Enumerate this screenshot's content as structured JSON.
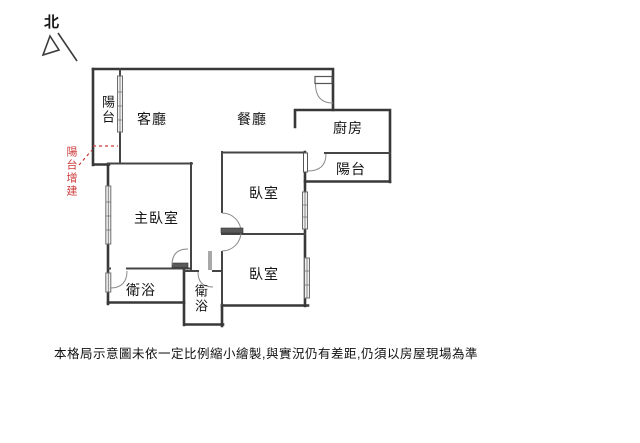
{
  "north": {
    "label": "北"
  },
  "rooms": {
    "living": "客廳",
    "dining": "餐廳",
    "kitchen": "廚房",
    "balcony_left": "陽台",
    "balcony_right": "陽台",
    "master_bedroom": "主臥室",
    "bedroom_1": "臥室",
    "bedroom_2": "臥室",
    "bathroom_1": "衛浴",
    "bathroom_2": "衛浴"
  },
  "annotation": {
    "balcony_extension": "陽台增建",
    "color": "#cc3b3b"
  },
  "disclaimer": "本格局示意圖未依一定比例縮小繪製,與實況仍有差距,仍須以房屋現場為準",
  "colors": {
    "wall": "#383838",
    "inner_wall": "#454545",
    "door_arc": "#8a8a8a",
    "window_fill": "#f0f0f0",
    "annotation_red": "#cc3b3b",
    "background": "#ffffff"
  }
}
